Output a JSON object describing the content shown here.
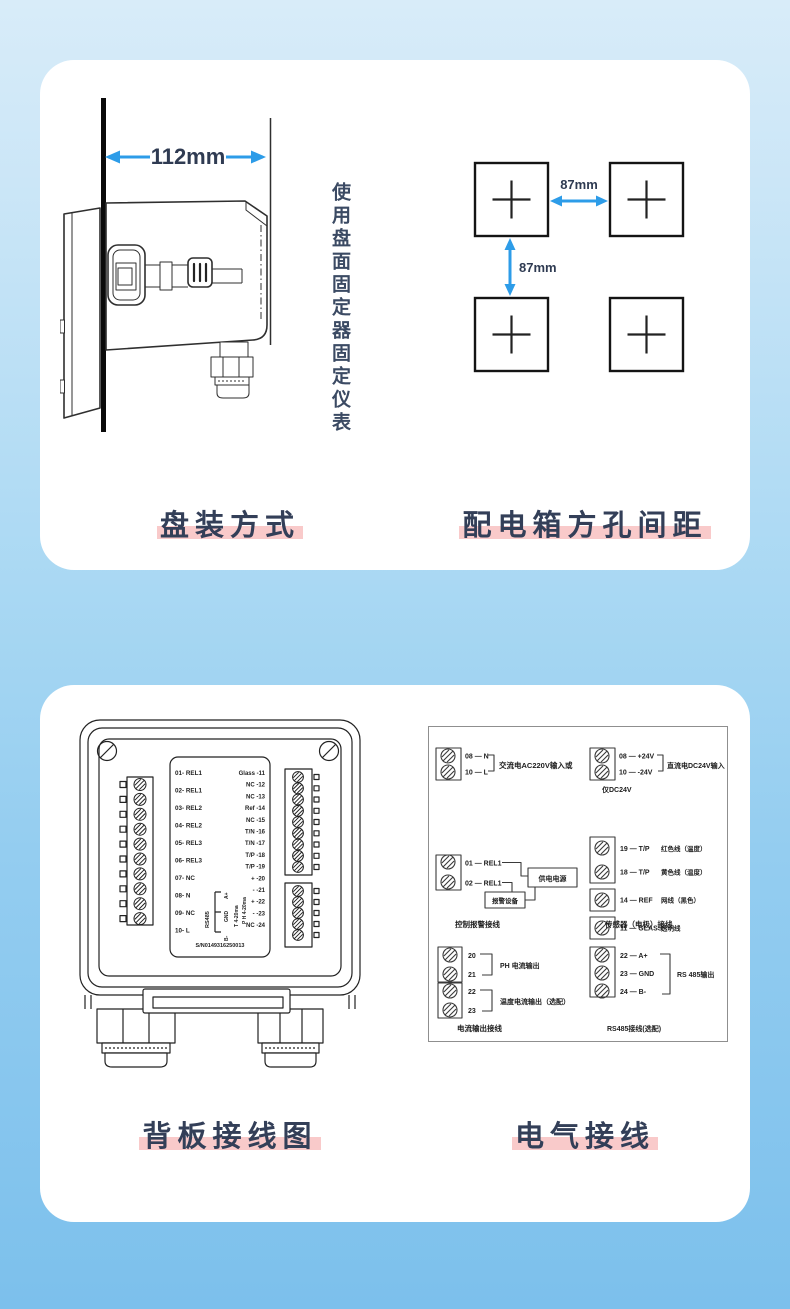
{
  "colors": {
    "accent_blue": "#2d9ce8",
    "highlight_pink": "#f9caca",
    "heading_text": "#333f58",
    "background_top": "#d8ecf9",
    "background_bottom": "#7cc0ec"
  },
  "card1": {
    "depth_dim": "112mm",
    "note": "使用盘面固定器固定仪表",
    "hole_gap_horizontal": "87mm",
    "hole_gap_vertical": "87mm",
    "caption_left": "盘装方式",
    "caption_right": "配电箱方孔间距"
  },
  "card2": {
    "caption_left": "背板接线图",
    "caption_right": "电气接线",
    "backpanel": {
      "left_terminals": [
        "01- REL1",
        "02- REL1",
        "03- REL2",
        "04- REL2",
        "05- REL3",
        "06- REL3",
        "07- NC",
        "08- N",
        "09- NC",
        "10- L"
      ],
      "right_terminals": [
        "Glass -11",
        "NC -12",
        "NC -13",
        "Ref -14",
        "NC -15",
        "T/N -16",
        "T/N -17",
        "T/P -18",
        "T/P -19",
        "+ -20",
        "-  -21",
        "+ -22",
        "-  -23",
        "NC -24"
      ],
      "rs485_label": "RS485",
      "rs485_pins": [
        "A+",
        "GND",
        "B-"
      ],
      "analog_ph": "P H 4-20ma",
      "analog_t": "T 4-20ma",
      "serial": "S/N0149316250013"
    },
    "wiring": {
      "ac": {
        "row1": "08 — N",
        "row2": "10 — L",
        "label": "交流电AC220V输入",
        "or": "或"
      },
      "dc": {
        "row1": "08 — +24V",
        "row2": "10 — -24V",
        "label": "直流电DC24V输入",
        "note": "仅DC24V"
      },
      "relay": {
        "row1": "01 — REL1",
        "row2": "02 — REL1",
        "power_box": "供电电源",
        "alarm_box": "报警设备",
        "caption": "控制报警接线"
      },
      "sensor": {
        "rows": [
          {
            "pins": "19 — T/P",
            "desc": "红色线（温度）"
          },
          {
            "pins": "18 — T/P",
            "desc": "黄色线（温度）"
          },
          {
            "pins": "14 — REF",
            "desc": "网线（黑色）"
          },
          {
            "pins": "11 — GLASS",
            "desc": "透明线"
          }
        ],
        "caption": "传感器（电极）接线"
      },
      "current": {
        "g1a": "20",
        "g1b": "21",
        "g1_label": "PH 电流输出",
        "g2a": "22",
        "g2b": "23",
        "g2_label": "温度电流输出（选配）",
        "caption": "电流输出接线"
      },
      "rs485": {
        "rows": [
          "22 — A+",
          "23 — GND",
          "24 — B-"
        ],
        "label": "RS 485输出",
        "caption": "RS485接线(选配)"
      }
    }
  }
}
